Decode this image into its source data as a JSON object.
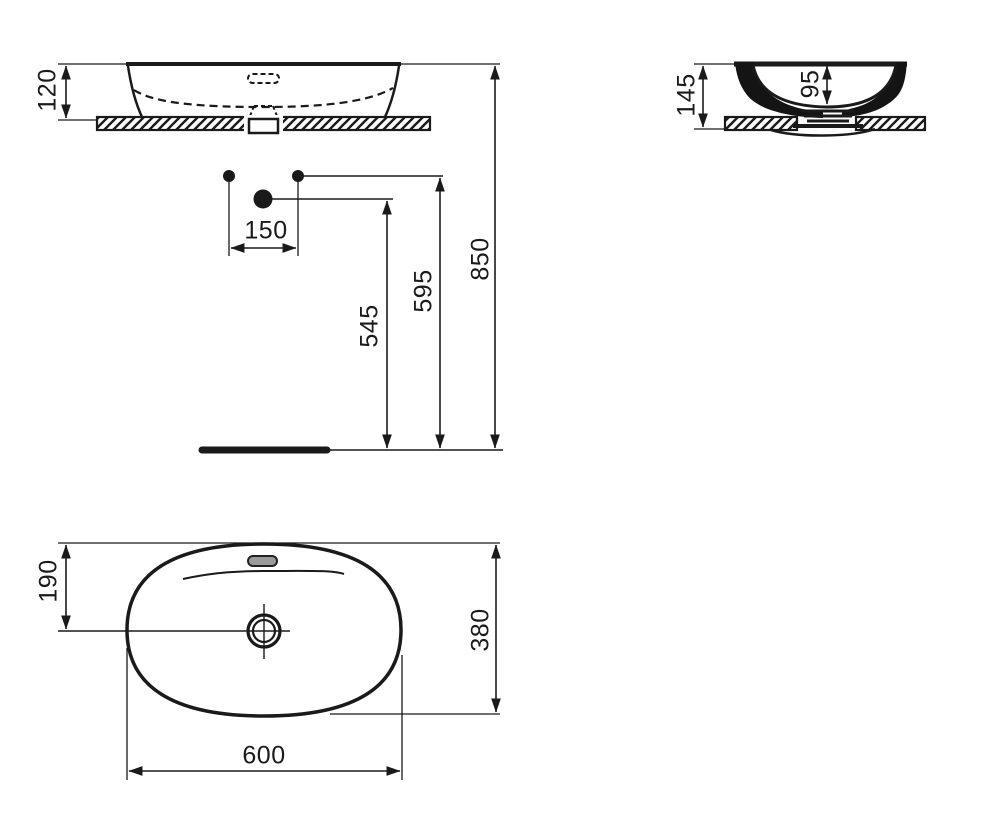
{
  "drawing": {
    "background": "#ffffff",
    "ink": "#1a1a1a",
    "front_view": {
      "basin_height_above_counter": "120",
      "tap_hole_spacing": "150",
      "drain_leader_height": "545",
      "tap_hole_height": "595",
      "rim_height_above_floor": "850"
    },
    "side_view": {
      "overall_height": "145",
      "inner_bowl_depth": "95"
    },
    "plan_view": {
      "drain_center_offset": "190",
      "overall_depth": "380",
      "overall_width": "600"
    }
  }
}
